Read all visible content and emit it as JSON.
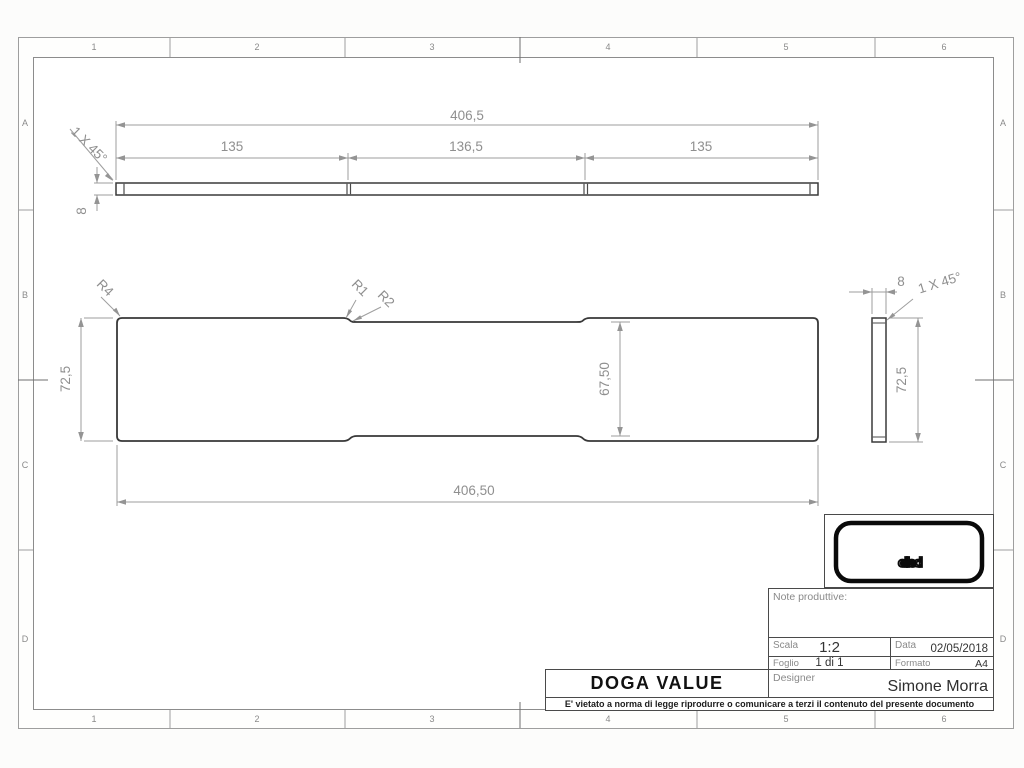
{
  "sheet": {
    "grid_cols": [
      "1",
      "2",
      "3",
      "4",
      "5",
      "6"
    ],
    "grid_rows": [
      "A",
      "B",
      "C",
      "D"
    ]
  },
  "drawing": {
    "top_view": {
      "total_length": "406,5",
      "seg_left": "135",
      "seg_mid": "136,5",
      "seg_right": "135",
      "thickness": "8",
      "chamfer_note": "1 X 45°"
    },
    "front_view": {
      "height": "72,5",
      "inner_height": "67,50",
      "total_length": "406,50",
      "radius_r4": "R4",
      "radius_r1": "R1",
      "radius_r2": "R2"
    },
    "side_view": {
      "width": "8",
      "chamfer_note": "1 X 45°",
      "height": "72,5"
    }
  },
  "title_block": {
    "logo_text": "elleci",
    "notes_label": "Note produttive:",
    "scala_label": "Scala",
    "scala_value": "1:2",
    "data_label": "Data",
    "data_value": "02/05/2018",
    "foglio_label": "Foglio",
    "foglio_value": "1 di 1",
    "formato_label": "Formato",
    "formato_value": "A4",
    "designer_label": "Designer",
    "designer_value": "Simone Morra",
    "part_name": "DOGA VALUE",
    "disclaimer": "E' vietato a norma di legge riprodurre o comunicare a terzi il contenuto del presente documento"
  },
  "colors": {
    "part_line": "#3a3a3a",
    "dimension_line": "#9e9e9e",
    "dimension_text": "#8f8f8f",
    "logo_teal": "#2e8289",
    "title_border": "#4a4a4a"
  }
}
